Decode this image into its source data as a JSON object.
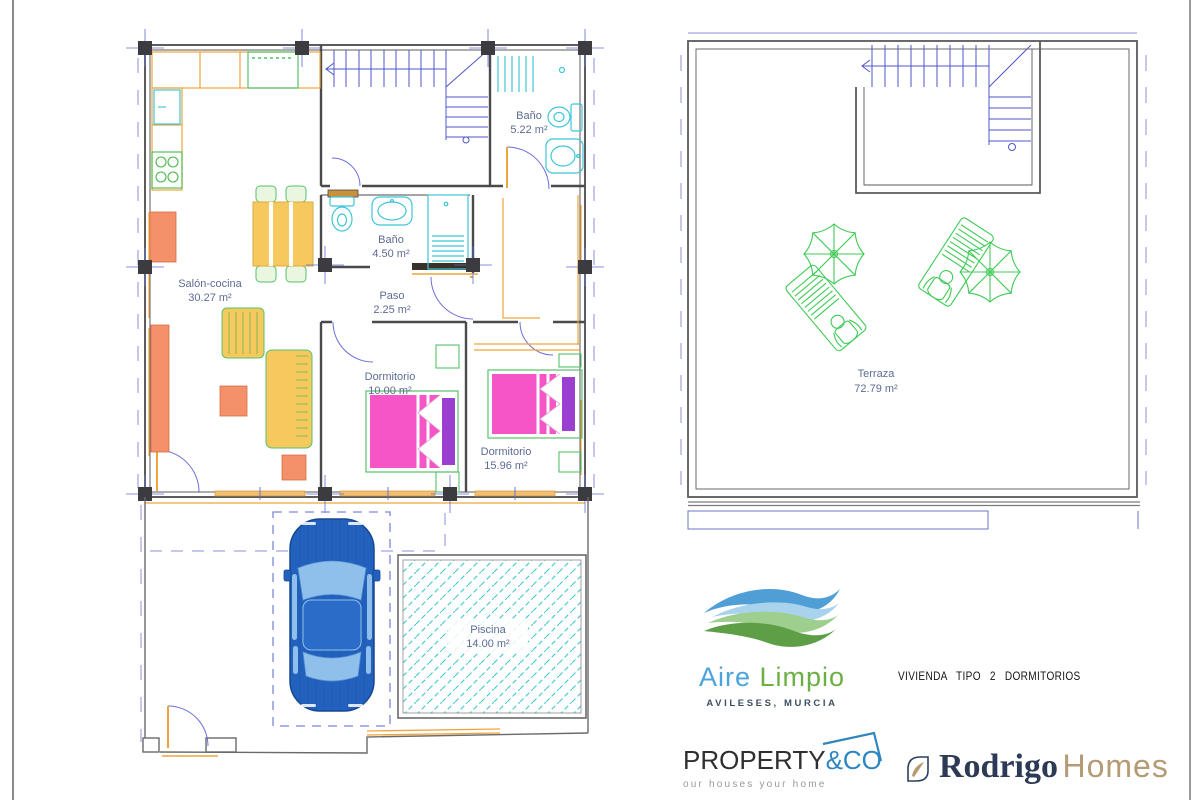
{
  "plan_labels": {
    "salon": {
      "name": "Salón-cocina",
      "area": "30.27 m²"
    },
    "bano_top": {
      "name": "Baño",
      "area": "5.22 m²"
    },
    "bano_mid": {
      "name": "Baño",
      "area": "4.50 m²"
    },
    "paso": {
      "name": "Paso",
      "area": "2.25 m²"
    },
    "dorm_small": {
      "name": "Dormitorio",
      "area": "10.00 m²"
    },
    "dorm_large": {
      "name": "Dormitorio",
      "area": "15.96 m²"
    },
    "piscina": {
      "name": "Piscina",
      "area": "14.00 m²"
    },
    "terraza": {
      "name": "Terraza",
      "area": "72.79 m²"
    }
  },
  "branding": {
    "aire_limpio": {
      "word1": "Aire",
      "word2": "Limpio",
      "subtitle": "AVILESES, MURCIA"
    },
    "plan_title": "VIVIENDA TIPO 2 DORMITORIOS",
    "property_co": {
      "word1": "PROPERTY",
      "word2": "&CO",
      "tagline": "our houses your home"
    },
    "rodrigo_homes": {
      "word1": "Rodrigo",
      "word2": "Homes"
    }
  },
  "colors": {
    "wall": "#4a4a4d",
    "cad_blue": "#4f56c8",
    "dashed_blue": "#8890dd",
    "fixture_cyan": "#3ec6d8",
    "furniture_orange": "#f0a43c",
    "furniture_green": "#55c26a",
    "terrace_green": "#3ecb55",
    "bed_pink": "#f655c8",
    "pillow_purple": "#9b3fd0",
    "sofa_yellow": "#f6c95f",
    "salmon": "#f4906a",
    "car_blue": "#2262be",
    "pool_teal": "#3fc8cc",
    "label_blue": "#5d6c94",
    "logo_blue": "#4aa3dc",
    "logo_green": "#6cb044",
    "property_blue": "#2e86c1",
    "rodrigo_navy": "#2c3a55",
    "rodrigo_tan": "#b49b74"
  }
}
